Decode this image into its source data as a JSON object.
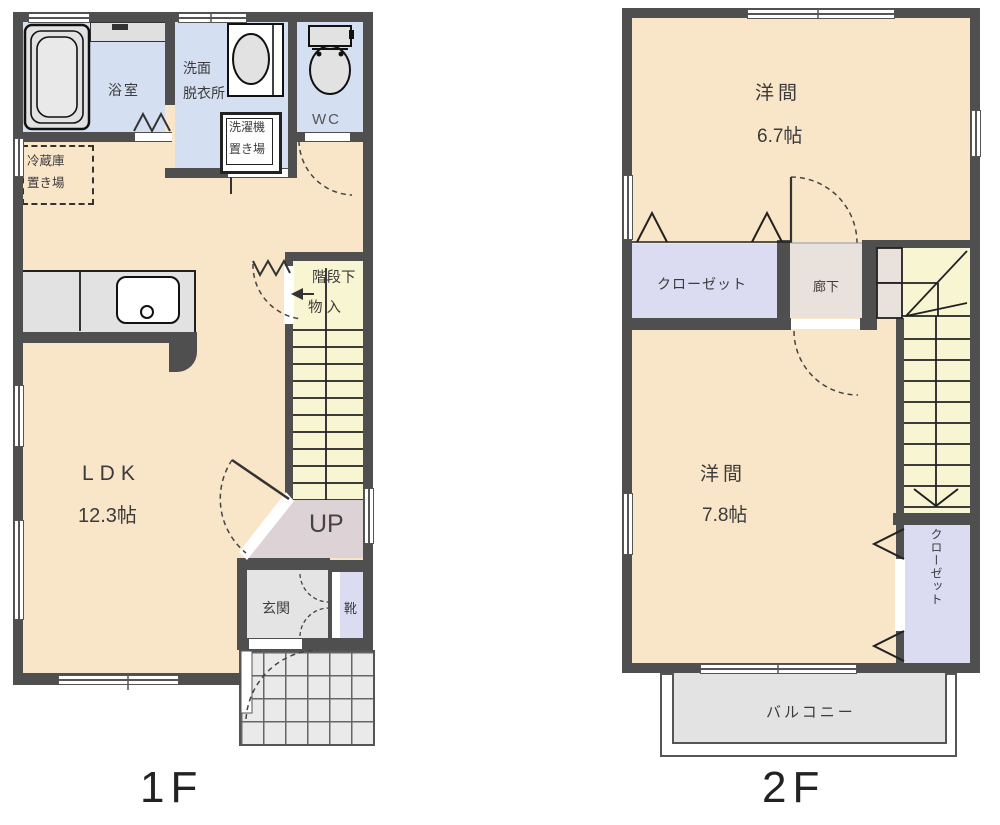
{
  "f1": {
    "title": "1F",
    "bath": "浴室",
    "washroom": [
      "洗面",
      "脱衣所"
    ],
    "wc": "WC",
    "laundry": [
      "洗濯機",
      "置き場"
    ],
    "fridge": [
      "冷蔵庫",
      "置き場"
    ],
    "ldk": [
      "LDK",
      "12.3帖"
    ],
    "stair_storage": [
      "階段下",
      "物 入"
    ],
    "up": "UP",
    "entrance": "玄関",
    "shoes": "靴"
  },
  "f2": {
    "title": "2F",
    "room1": [
      "洋間",
      "6.7帖"
    ],
    "room2": [
      "洋間",
      "7.8帖"
    ],
    "closet_top": "クローゼット",
    "closet_side": "クローゼット",
    "hallway": "廊下",
    "balcony": "バルコニー"
  },
  "colors": {
    "wall": "#4f4f4f",
    "floor_main": "#f9e5c8",
    "floor_wet": "#d5dff2",
    "floor_stairs": "#f8f5d2",
    "floor_closet": "#dbdbf2",
    "floor_entry": "#e4e4e4",
    "floor_up_landing": "#ddd3d6",
    "floor_hall_2f": "#e8e1dc",
    "porch_tile": "#eaeaea"
  }
}
